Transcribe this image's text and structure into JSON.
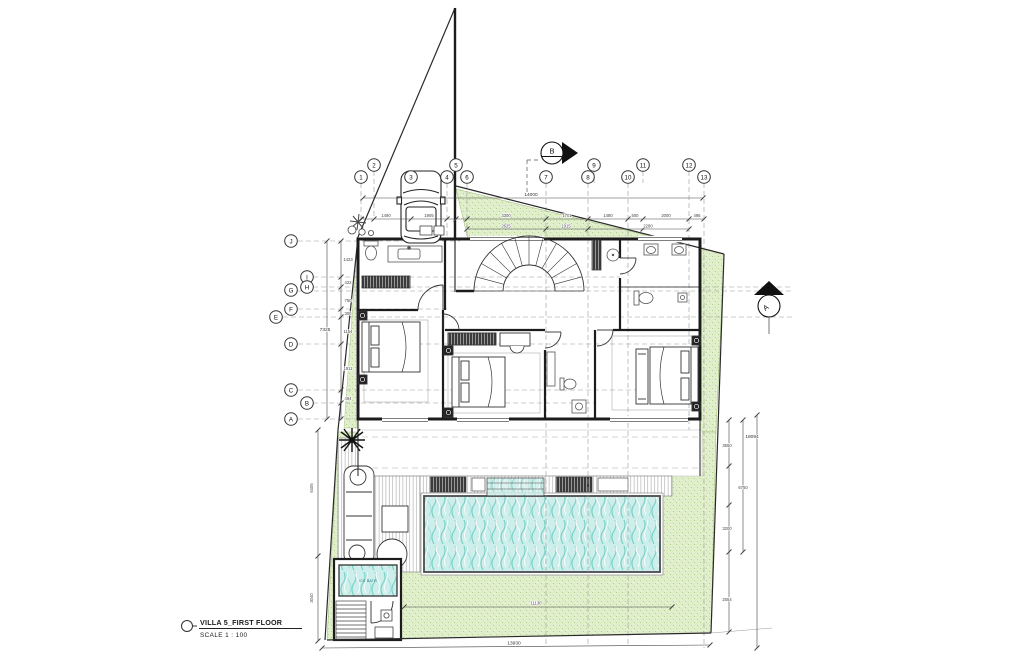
{
  "title_block": {
    "title": "VILLA 5_FIRST FLOOR",
    "scale": "SCALE 1 : 100"
  },
  "grid": {
    "columns": [
      "1",
      "2",
      "3",
      "4",
      "5",
      "6",
      "7",
      "8",
      "9",
      "10",
      "11",
      "12",
      "13"
    ],
    "rows": [
      "J",
      "I",
      "H",
      "G",
      "F",
      "E",
      "D",
      "C",
      "B",
      "A"
    ]
  },
  "section_markers": {
    "top": "B",
    "right": "A"
  },
  "rooms": {
    "ice_bath_label": "ICE BATH"
  },
  "dimensions": {
    "top_total": "14000",
    "top_chain": [
      "1490",
      "1905",
      "3300",
      "1701",
      "1480",
      "500",
      "2000",
      "495"
    ],
    "top_chain2": [
      "2625",
      "1915",
      "2280"
    ],
    "left_chain": [
      "1423",
      "422",
      "750",
      "300",
      "1154",
      "1911",
      "494"
    ],
    "left_total": "7325",
    "left_lower": [
      "6405",
      "3040"
    ],
    "right_chain": [
      "3550",
      "3200",
      "2554"
    ],
    "right_inner_total": "6750",
    "right_total": "18094",
    "bottom_total": "13930",
    "pool_width": "11130"
  },
  "colors": {
    "site_green": "#e3f0cf",
    "green_texture": "#b3d28c",
    "pool_water": "#cdeeea",
    "wave": "#74cfc6",
    "wall": "#1c1c1c",
    "grid_line": "#9a9a9a",
    "dim_text": "#333333"
  }
}
